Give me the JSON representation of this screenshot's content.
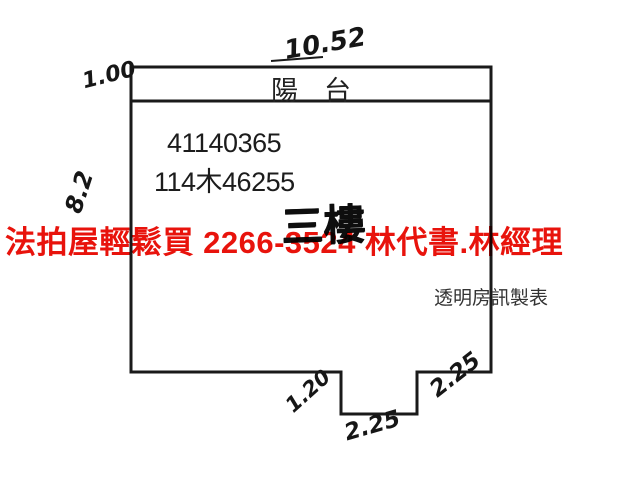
{
  "watermark": {
    "text": "法拍屋輕鬆買  2266-3524  林代書.林經理",
    "phone": "2266-3524",
    "color": "#e8130c"
  },
  "plan": {
    "balcony_label": "陽台",
    "case_numbers": {
      "line1": "41140365",
      "line2": "114木46255"
    },
    "floor_label": "三樓",
    "publisher": "透明房訊製表",
    "dimensions": {
      "top_width": "10.52",
      "balcony_depth": "1.00",
      "left_height": "8.2",
      "notch_depth": "1.20",
      "notch_width": "2.25",
      "bottom_right_width": "2.25"
    }
  },
  "colors": {
    "line": "#1a1a1a",
    "ink": "#1a1a1a",
    "watermark_red": "#e8130c",
    "background": "#ffffff"
  }
}
